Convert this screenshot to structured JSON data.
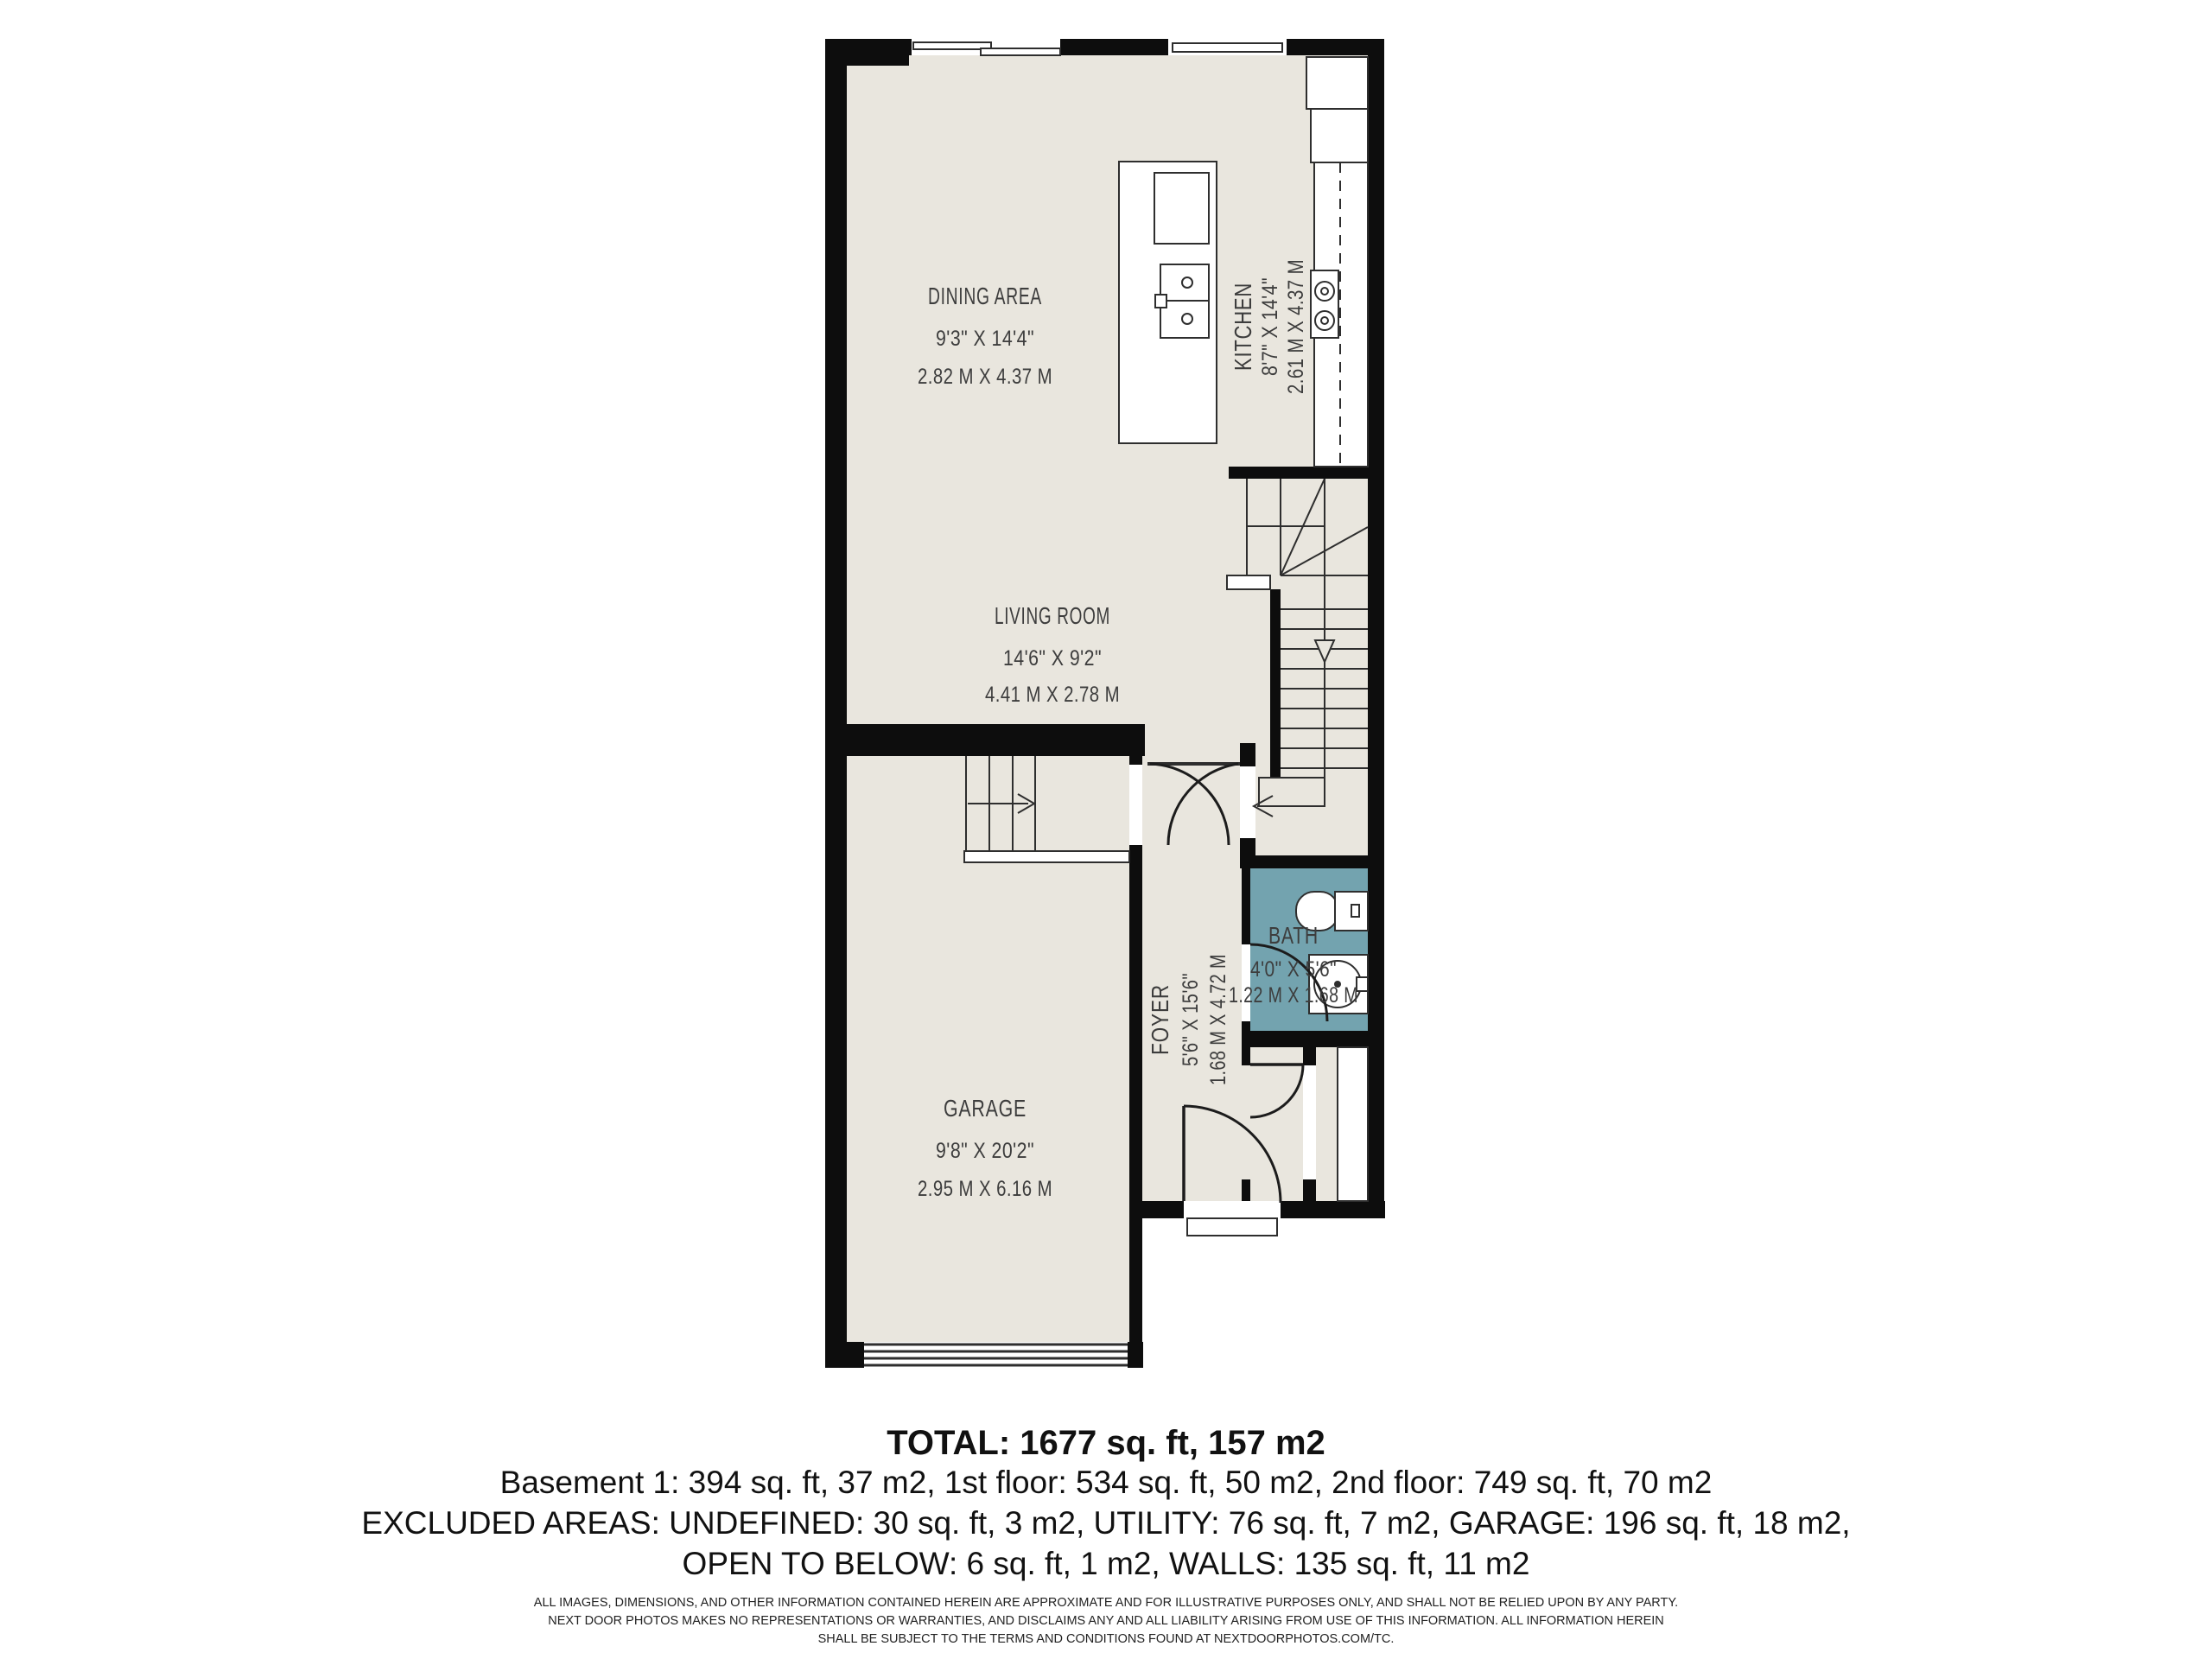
{
  "plan": {
    "colors": {
      "floor": "#e9e6de",
      "bath_floor": "#73a3af",
      "wall": "#0d0d0d"
    },
    "rooms": {
      "dining": {
        "name": "DINING AREA",
        "imperial": "9'3\" X 14'4\"",
        "metric": "2.82 M X 4.37 M"
      },
      "kitchen": {
        "name": "KITCHEN",
        "imperial": "8'7\" X 14'4\"",
        "metric": "2.61 M X 4.37 M"
      },
      "living": {
        "name": "LIVING ROOM",
        "imperial": "14'6\" X 9'2\"",
        "metric": "4.41 M X 2.78 M"
      },
      "garage": {
        "name": "GARAGE",
        "imperial": "9'8\" X 20'2\"",
        "metric": "2.95 M X 6.16 M"
      },
      "foyer": {
        "name": "FOYER",
        "imperial": "5'6\" X 15'6\"",
        "metric": "1.68 M X 4.72 M"
      },
      "bath": {
        "name": "BATH",
        "imperial": "4'0\" X 5'6\"",
        "metric": "1.22 M X 1.68 M"
      }
    }
  },
  "summary": {
    "total": "TOTAL: 1677 sq. ft, 157 m2",
    "floors": "Basement 1: 394 sq. ft, 37 m2, 1st floor: 534 sq. ft, 50 m2, 2nd floor: 749 sq. ft, 70 m2",
    "excluded_1": "EXCLUDED AREAS: UNDEFINED: 30 sq. ft, 3 m2, UTILITY: 76 sq. ft, 7 m2, GARAGE: 196 sq. ft, 18 m2,",
    "excluded_2": "OPEN TO BELOW: 6 sq. ft, 1 m2, WALLS: 135 sq. ft, 11 m2",
    "disclaimer_1": "ALL IMAGES, DIMENSIONS, AND OTHER INFORMATION CONTAINED HEREIN ARE APPROXIMATE AND FOR ILLUSTRATIVE PURPOSES ONLY, AND SHALL NOT BE RELIED UPON BY ANY PARTY.",
    "disclaimer_2": "NEXT DOOR PHOTOS MAKES NO REPRESENTATIONS OR WARRANTIES, AND DISCLAIMS ANY AND ALL LIABILITY ARISING FROM USE OF THIS INFORMATION. ALL INFORMATION HEREIN",
    "disclaimer_3": "SHALL BE SUBJECT TO THE TERMS AND CONDITIONS FOUND AT NEXTDOORPHOTOS.COM/TC."
  }
}
